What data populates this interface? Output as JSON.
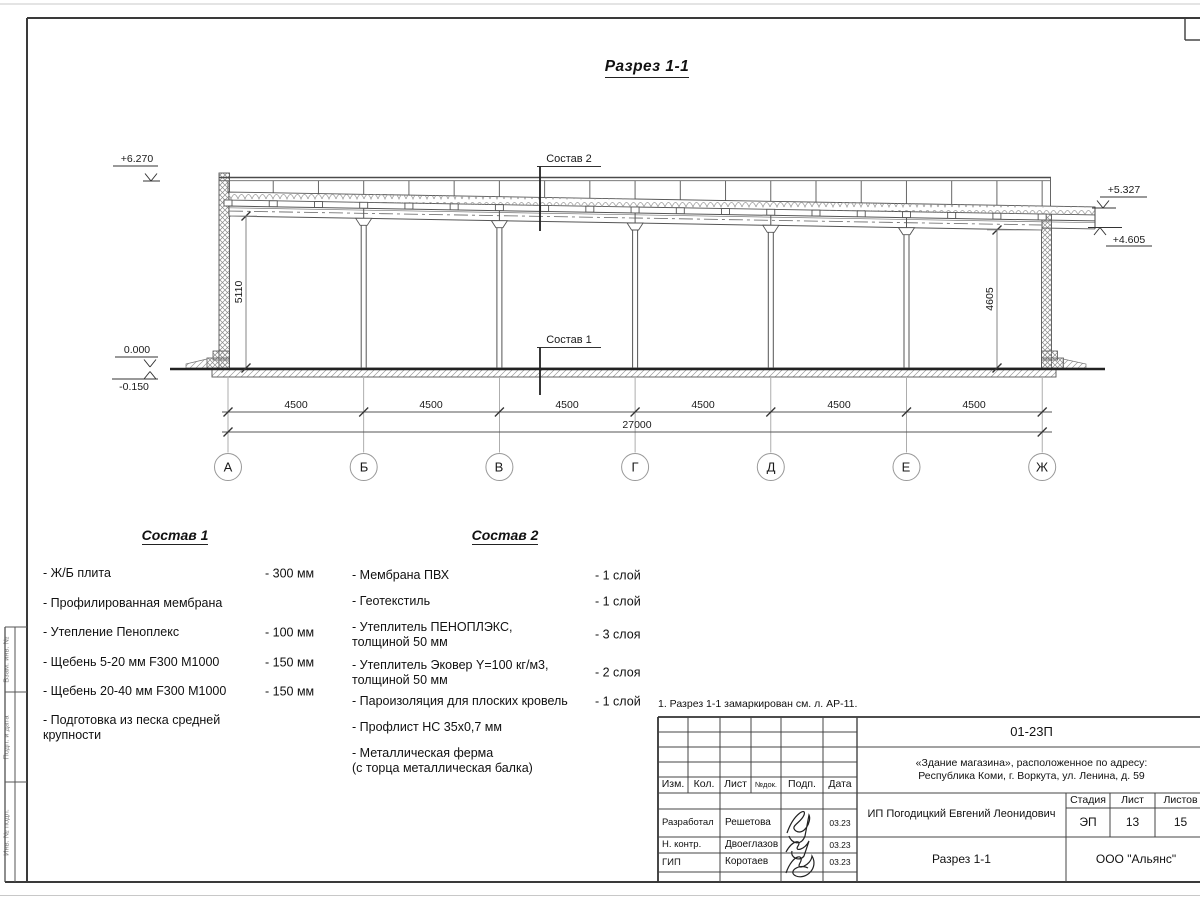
{
  "sheet_title": "Разрез 1-1",
  "section": {
    "elevations": {
      "top_left": "+6.270",
      "zero": "0.000",
      "below_zero": "-0.150",
      "right_upper": "+5.327",
      "right_lower": "+4.605"
    },
    "vertical_dims": {
      "left": "5110",
      "right": "4605"
    },
    "bay_dims": [
      "4500",
      "4500",
      "4500",
      "4500",
      "4500",
      "4500"
    ],
    "total_dim": "27000",
    "axes": [
      "А",
      "Б",
      "В",
      "Г",
      "Д",
      "Е",
      "Ж"
    ],
    "labels": {
      "sostav1": "Состав 1",
      "sostav2": "Состав 2"
    }
  },
  "comp1": {
    "title": "Состав 1",
    "items": [
      {
        "name": "- Ж/Б плита",
        "value": "- 300 мм"
      },
      {
        "name": "- Профилированная мембрана",
        "value": ""
      },
      {
        "name": "- Утепление Пеноплекс",
        "value": "- 100 мм"
      },
      {
        "name": "-  Щебень 5-20 мм F300 М1000",
        "value": "- 150 мм"
      },
      {
        "name": "-  Щебень 20-40 мм F300 М1000",
        "value": "- 150 мм"
      },
      {
        "name": "- Подготовка из песка средней\nкрупности",
        "value": ""
      }
    ]
  },
  "comp2": {
    "title": "Состав 2",
    "items": [
      {
        "name": "- Мембрана ПВХ",
        "value": "- 1 слой"
      },
      {
        "name": "- Геотекстиль",
        "value": "- 1 слой"
      },
      {
        "name": "- Утеплитель ПЕНОПЛЭКС,\nтолщиной 50 мм",
        "value": "- 3 слоя"
      },
      {
        "name": "- Утеплитель Эковер Y=100 кг/м3,\nтолщиной 50 мм",
        "value": "- 2 слоя"
      },
      {
        "name": "- Пароизоляция для плоских кровель",
        "value": "- 1 слой"
      },
      {
        "name": "- Профлист НС 35х0,7 мм",
        "value": ""
      },
      {
        "name": "- Металлическая ферма\n(с торца металлическая балка)",
        "value": ""
      }
    ]
  },
  "note": "1. Разрез 1-1 замаркирован см. л. АР-11.",
  "titleblock": {
    "doc_number": "01-23П",
    "project_line1": "«Здание магазина», расположенное по адресу:",
    "project_line2": "Республика Коми, г. Воркута, ул. Ленина, д. 59",
    "client": "ИП Погодицкий Евгений Леонидович",
    "drawing_title": "Разрез 1-1",
    "company": "ООО \"Альянс\"",
    "headers": {
      "izm": "Изм.",
      "kol": "Кол.",
      "list": "Лист",
      "ndok": "№док.",
      "podp": "Подп.",
      "data": "Дата",
      "stage": "Стадия",
      "sheet": "Лист",
      "sheets": "Листов"
    },
    "stage": "ЭП",
    "sheet_no": "13",
    "sheet_total": "15",
    "rows": [
      {
        "role": "Разработал",
        "name": "Решетова",
        "date": "03.23"
      },
      {
        "role": "Н. контр.",
        "name": "Двоеглазов",
        "date": "03.23"
      },
      {
        "role": "ГИП",
        "name": "Коротаев",
        "date": "03.23"
      }
    ]
  },
  "side_stamp": {
    "cells": [
      "Взам. инв. №",
      "Подп. и дата",
      "Инв. № подл."
    ]
  },
  "colors": {
    "line": "#555555",
    "heavy": "#222222",
    "frame": "#3a3a3a"
  }
}
